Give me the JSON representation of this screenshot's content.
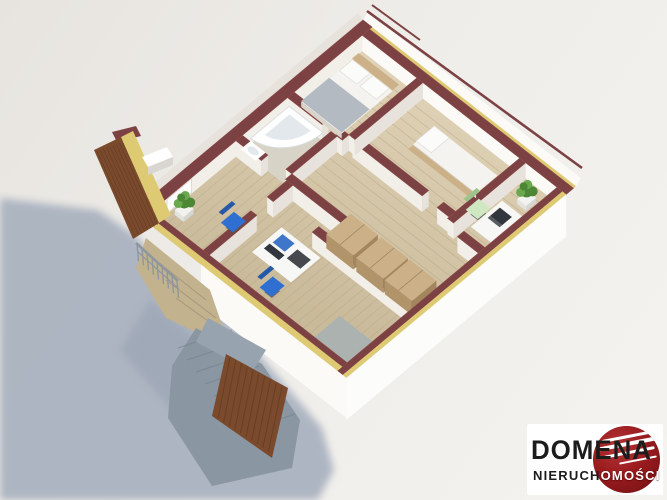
{
  "logo": {
    "brand": "DOMENA",
    "subtitle_prefix": "NIERUCH",
    "subtitle_suffix": "OMOŚCI",
    "subtitle_full": "NIERUCHOMOŚCI"
  },
  "colors": {
    "bg_dark": "#e7e4df",
    "bg_light": "#f5f3ef",
    "shadow": "#a8b1bf",
    "floor_light": "#decfb3",
    "floor_dark": "#cbbc9c",
    "floor_stripe": "#b3a385",
    "bath_tile": "#d8d3c7",
    "wall_top": "#7c4142",
    "wall_top_edge": "#8d4c4a",
    "insulation": "#dfca74",
    "face_bright": "#fbfaf7",
    "face_soft": "#f2efe9",
    "face_shade": "#e7e3dc",
    "ext_white": "#fcfcfa",
    "window_recess": "#d7d4cf",
    "wood": "#cbb088",
    "wood_face": "#b2946a",
    "wood_dark": "#a3865e",
    "roof_brown": "#7b4a2c",
    "roof_dark": "#5e3a20",
    "deck": "#c3b28e",
    "deck_line": "#a8977a",
    "stone": "#8a96a2",
    "stone_dark": "#76838f",
    "railing": "#8f979f",
    "plant_green": "#4c8736",
    "plant_light": "#6aa84e",
    "pot_white": "#f2f2f0",
    "bed_white": "#f4f3f0",
    "pillow": "#fbfbf9",
    "blanket": "#b4bac1",
    "desk_white": "#f7f7f6",
    "chair_blue": "#2e6fd1",
    "chair_blue_dark": "#2558a8",
    "chair_green": "#cfe8c2",
    "chair_green_dark": "#9cc48b",
    "laptop_dark": "#32373d",
    "laptop_blue": "#3f76c9",
    "tub_bowl": "#e2e8ec",
    "rug_gray": "#a9b1b3",
    "logo_box": "#ffffff",
    "logo_red": "#9b1c1f",
    "logo_red_light": "#b13538",
    "logo_red_dark": "#6e0f12",
    "text_black": "#1c1c1c"
  }
}
